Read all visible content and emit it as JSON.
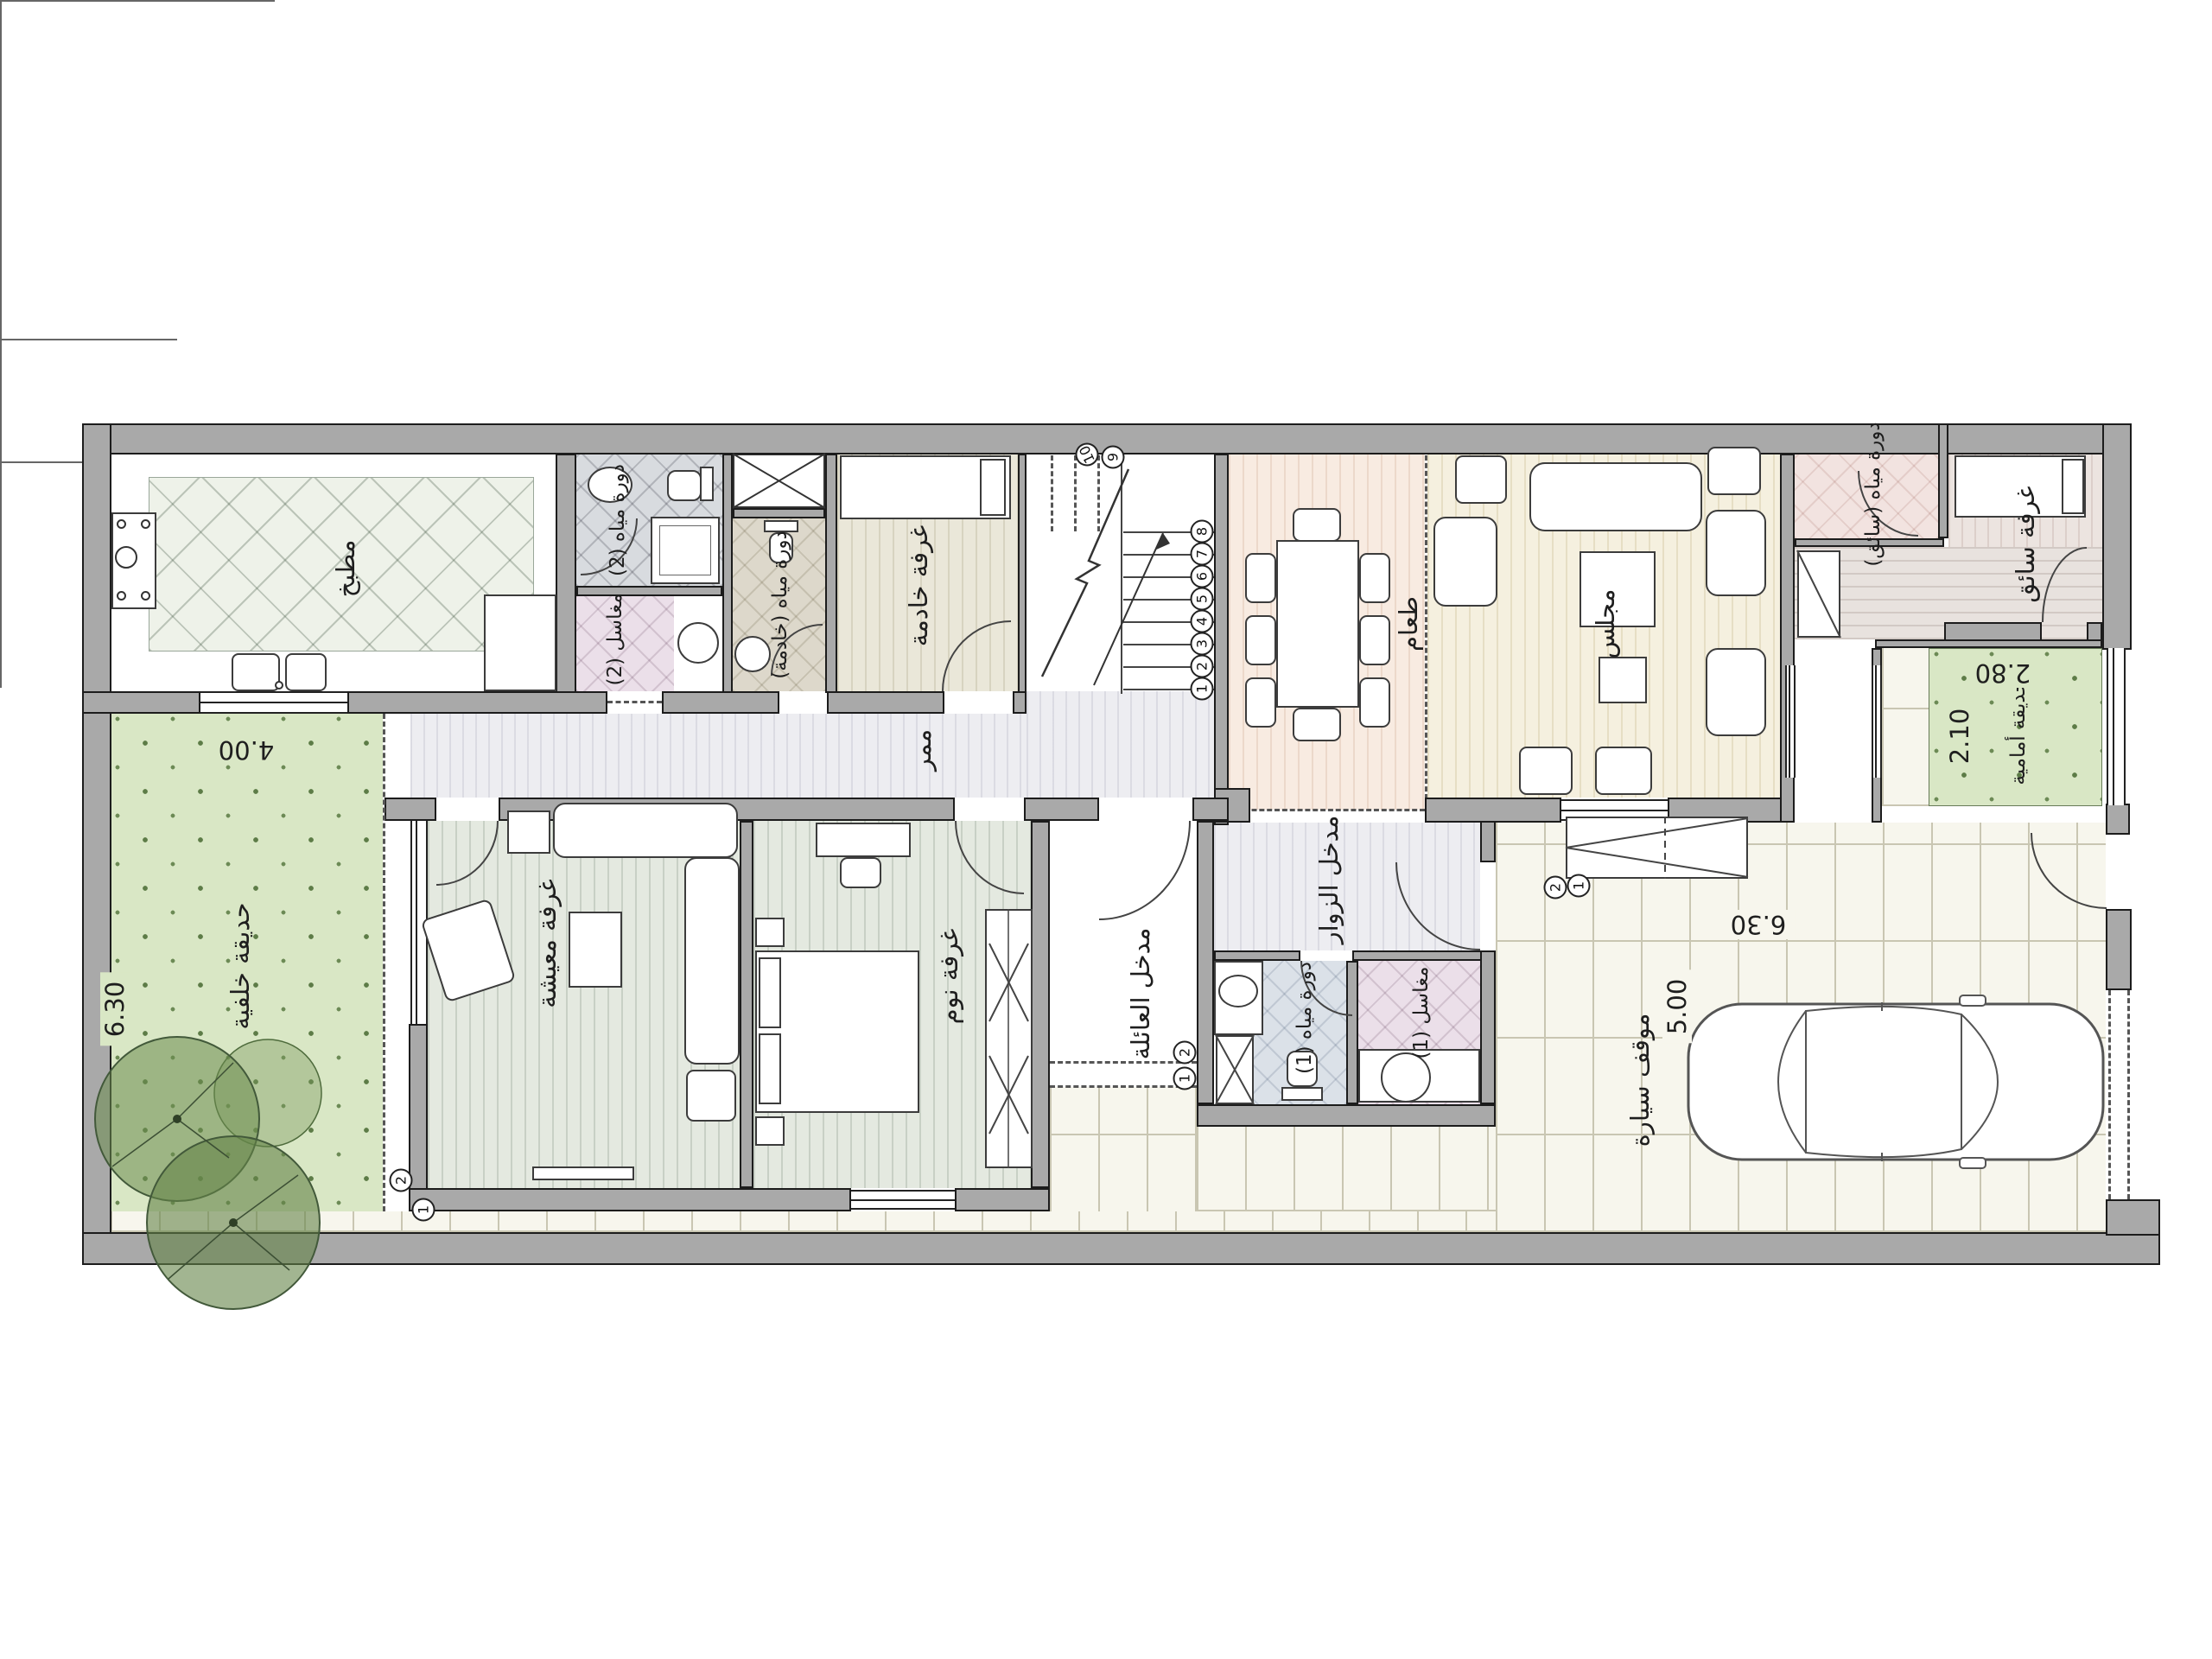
{
  "labels": {
    "kitchen": "مطبخ",
    "bath2": "دورة مياه (2)",
    "sinks2": "مغاسل (2)",
    "maid_bath": "دورة مياه (خادمة)",
    "maid_room": "غرفة خادمة",
    "corridor": "ممر",
    "dining": "طعام",
    "majlis": "مجلس",
    "driver_bath": "دورة مياه (سائق)",
    "driver_room": "غرفة سائق",
    "front_garden": "حديقة أمامية",
    "back_garden": "حديقة خلفية",
    "living": "غرفة معيشة",
    "bedroom": "غرفة نوم",
    "family_entrance": "مدخل العائلة",
    "visitor_entrance": "مدخل الزوار",
    "bath1": "دورة مياه (1)",
    "sinks1": "مغاسل (1)",
    "parking": "موقف سيارة"
  },
  "dimensions": {
    "back_garden_width": "4.00",
    "back_garden_depth": "6.30",
    "front_garden_width": "2.80",
    "front_garden_depth": "2.10",
    "yard_width": "6.30",
    "parking_length": "5.00"
  },
  "stairs": {
    "steps": [
      "1",
      "2",
      "3",
      "4",
      "5",
      "6",
      "7",
      "8",
      "9",
      "10"
    ]
  },
  "markers": {
    "one": "1",
    "two": "2"
  },
  "colors": {
    "wall": "#a9a9a9",
    "grass": "#d9e7c5",
    "paving": "#f7f6ed",
    "sage_room": "#e4e9e0",
    "dining_room": "#f8ebe1",
    "majlis_room": "#f5f0df",
    "bath_gray": "#d8dbdf",
    "bath_pink": "#ebdfe9"
  }
}
